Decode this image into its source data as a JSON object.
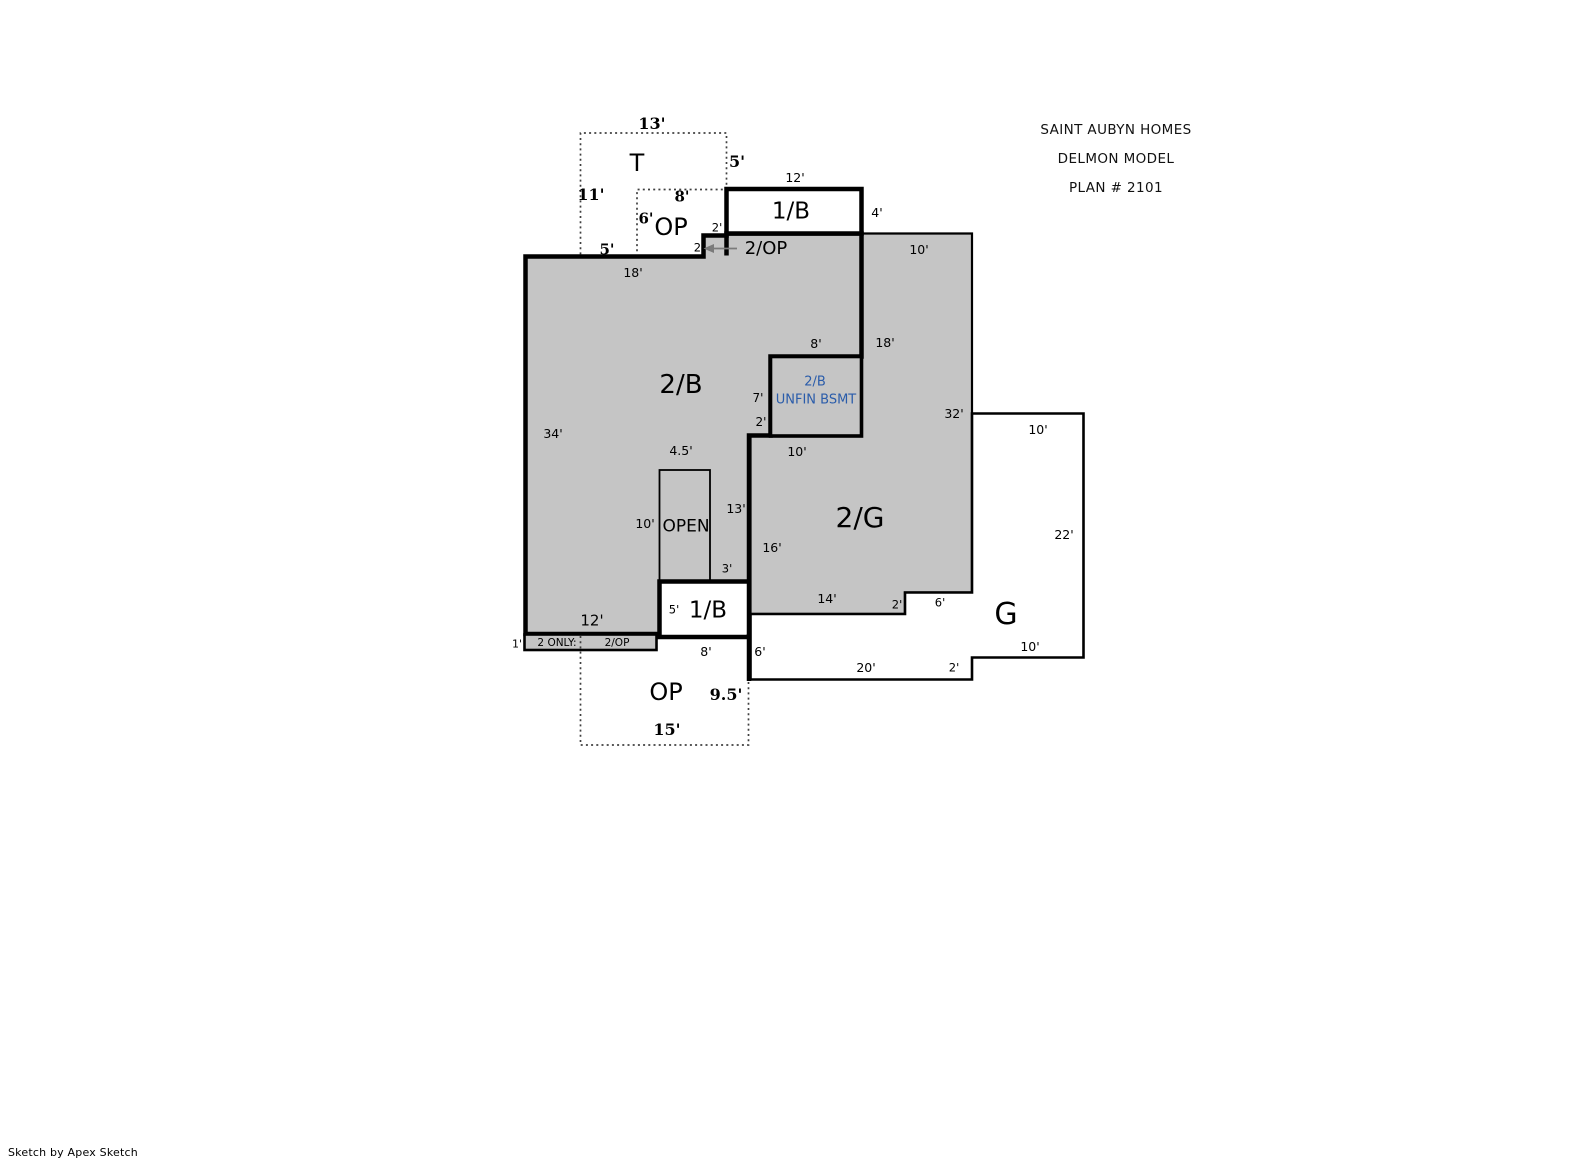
{
  "header": {
    "line1": "SAINT AUBYN HOMES",
    "line2": "DELMON MODEL",
    "line3": "PLAN # 2101"
  },
  "footer": {
    "credit": "Sketch by Apex Sketch"
  },
  "colors": {
    "area_fill": "#c5c5c5",
    "outline": "#000000",
    "dotted": "#404040",
    "arrow": "#7a7a7a",
    "unfin_blue": "#2a5caa",
    "background": "#ffffff"
  },
  "labels": [
    {
      "name": "dim-t-width",
      "text": "13'",
      "x": 652,
      "y": 124,
      "size": 16,
      "bold": true,
      "serif": true
    },
    {
      "name": "area-label-t",
      "text": "T",
      "x": 637,
      "y": 163,
      "size": 24
    },
    {
      "name": "dim-t-right",
      "text": "5'",
      "x": 737,
      "y": 162,
      "size": 16,
      "bold": true,
      "serif": true
    },
    {
      "name": "dim-t-left",
      "text": "11'",
      "x": 591,
      "y": 195,
      "size": 16,
      "bold": true,
      "serif": true
    },
    {
      "name": "dim-op-top-width",
      "text": "8'",
      "x": 682,
      "y": 197,
      "size": 15,
      "bold": true,
      "serif": true
    },
    {
      "name": "dim-op-top-left",
      "text": "6'",
      "x": 646,
      "y": 219,
      "size": 15,
      "bold": true,
      "serif": true
    },
    {
      "name": "area-label-op-top",
      "text": "OP",
      "x": 671,
      "y": 227,
      "size": 24
    },
    {
      "name": "dim-t-bottom",
      "text": "5'",
      "x": 607,
      "y": 250,
      "size": 15,
      "bold": true,
      "serif": true
    },
    {
      "name": "dim-notch-width",
      "text": "2'",
      "x": 717,
      "y": 228,
      "size": 11.5
    },
    {
      "name": "dim-notch-height",
      "text": "2'",
      "x": 699,
      "y": 248,
      "size": 11.5
    },
    {
      "name": "area-label-2op",
      "text": "2/OP",
      "x": 766,
      "y": 249,
      "size": 18
    },
    {
      "name": "dim-1b-upper-width",
      "text": "12'",
      "x": 795,
      "y": 178,
      "size": 12.5
    },
    {
      "name": "area-label-1b-upper",
      "text": "1/B",
      "x": 791,
      "y": 212,
      "size": 23
    },
    {
      "name": "dim-1b-upper-right",
      "text": "4'",
      "x": 877,
      "y": 213,
      "size": 12.5
    },
    {
      "name": "dim-2g-top",
      "text": "10'",
      "x": 919,
      "y": 250,
      "size": 12.5
    },
    {
      "name": "dim-2b-top",
      "text": "18'",
      "x": 633,
      "y": 273,
      "size": 12.5
    },
    {
      "name": "area-label-2b",
      "text": "2/B",
      "x": 681,
      "y": 385,
      "size": 26
    },
    {
      "name": "dim-2b-left",
      "text": "34'",
      "x": 553,
      "y": 434,
      "size": 12.5
    },
    {
      "name": "dim-unfin-top",
      "text": "8'",
      "x": 816,
      "y": 344,
      "size": 12.5
    },
    {
      "name": "dim-2b-2g-boundary",
      "text": "18'",
      "x": 885,
      "y": 343,
      "size": 12.5
    },
    {
      "name": "label-unfin-2b",
      "text": "2/B",
      "x": 815,
      "y": 382,
      "size": 13,
      "color": "#2a5caa"
    },
    {
      "name": "label-unfin-bsmt",
      "text": "UNFIN BSMT",
      "x": 816,
      "y": 400,
      "size": 13,
      "color": "#2a5caa"
    },
    {
      "name": "dim-unfin-left",
      "text": "7'",
      "x": 758,
      "y": 398,
      "size": 12
    },
    {
      "name": "dim-unfin-step",
      "text": "2'",
      "x": 761,
      "y": 422,
      "size": 12
    },
    {
      "name": "dim-2g-right",
      "text": "32'",
      "x": 954,
      "y": 414,
      "size": 12.5
    },
    {
      "name": "dim-2g-under-unfin",
      "text": "10'",
      "x": 797,
      "y": 452,
      "size": 12.5
    },
    {
      "name": "area-label-2g",
      "text": "2/G",
      "x": 860,
      "y": 518,
      "size": 28
    },
    {
      "name": "dim-2b-right",
      "text": "13'",
      "x": 736,
      "y": 509,
      "size": 12.5
    },
    {
      "name": "dim-2g-left",
      "text": "16'",
      "x": 772,
      "y": 548,
      "size": 12.5
    },
    {
      "name": "dim-2g-bottom",
      "text": "14'",
      "x": 827,
      "y": 599,
      "size": 12.5
    },
    {
      "name": "dim-2g-step-v",
      "text": "2'",
      "x": 897,
      "y": 605,
      "size": 11.5
    },
    {
      "name": "dim-2g-step-h",
      "text": "6'",
      "x": 940,
      "y": 603,
      "size": 11.5
    },
    {
      "name": "dim-open-width",
      "text": "4.5'",
      "x": 681,
      "y": 451,
      "size": 12.5
    },
    {
      "name": "dim-open-left",
      "text": "10'",
      "x": 645,
      "y": 524,
      "size": 12.5
    },
    {
      "name": "area-label-open",
      "text": "OPEN",
      "x": 686,
      "y": 527,
      "size": 17
    },
    {
      "name": "dim-open-right",
      "text": "3'",
      "x": 727,
      "y": 569,
      "size": 11.5
    },
    {
      "name": "dim-1b-lower-height",
      "text": "5'",
      "x": 674,
      "y": 610,
      "size": 11.5
    },
    {
      "name": "area-label-1b-lower",
      "text": "1/B",
      "x": 708,
      "y": 611,
      "size": 23
    },
    {
      "name": "dim-1b-lower-width",
      "text": "8'",
      "x": 706,
      "y": 652,
      "size": 12.5
    },
    {
      "name": "dim-2b-bottom",
      "text": "12'",
      "x": 592,
      "y": 621,
      "size": 15
    },
    {
      "name": "dim-strip-height",
      "text": "1'",
      "x": 517,
      "y": 644,
      "size": 11
    },
    {
      "name": "label-strip-2only",
      "text": "2 ONLY:",
      "x": 557,
      "y": 643,
      "size": 10.5
    },
    {
      "name": "label-strip-2op",
      "text": "2/OP",
      "x": 617,
      "y": 643,
      "size": 10.5
    },
    {
      "name": "dim-g-top",
      "text": "10'",
      "x": 1038,
      "y": 430,
      "size": 12.5
    },
    {
      "name": "dim-g-right",
      "text": "22'",
      "x": 1064,
      "y": 535,
      "size": 12.5
    },
    {
      "name": "area-label-g",
      "text": "G",
      "x": 1006,
      "y": 615,
      "size": 30
    },
    {
      "name": "dim-g-left",
      "text": "6'",
      "x": 760,
      "y": 652,
      "size": 12.5
    },
    {
      "name": "dim-g-bottom",
      "text": "20'",
      "x": 866,
      "y": 668,
      "size": 12.5
    },
    {
      "name": "dim-g-step-v",
      "text": "2'",
      "x": 954,
      "y": 668,
      "size": 11.5
    },
    {
      "name": "dim-g-step-h",
      "text": "10'",
      "x": 1030,
      "y": 647,
      "size": 12.5
    },
    {
      "name": "area-label-op-bottom",
      "text": "OP",
      "x": 666,
      "y": 692,
      "size": 24
    },
    {
      "name": "dim-op-bottom-right",
      "text": "9.5'",
      "x": 726,
      "y": 695,
      "size": 16,
      "bold": true,
      "serif": true
    },
    {
      "name": "dim-op-bottom-width",
      "text": "15'",
      "x": 667,
      "y": 730,
      "size": 16,
      "bold": true,
      "serif": true
    }
  ]
}
